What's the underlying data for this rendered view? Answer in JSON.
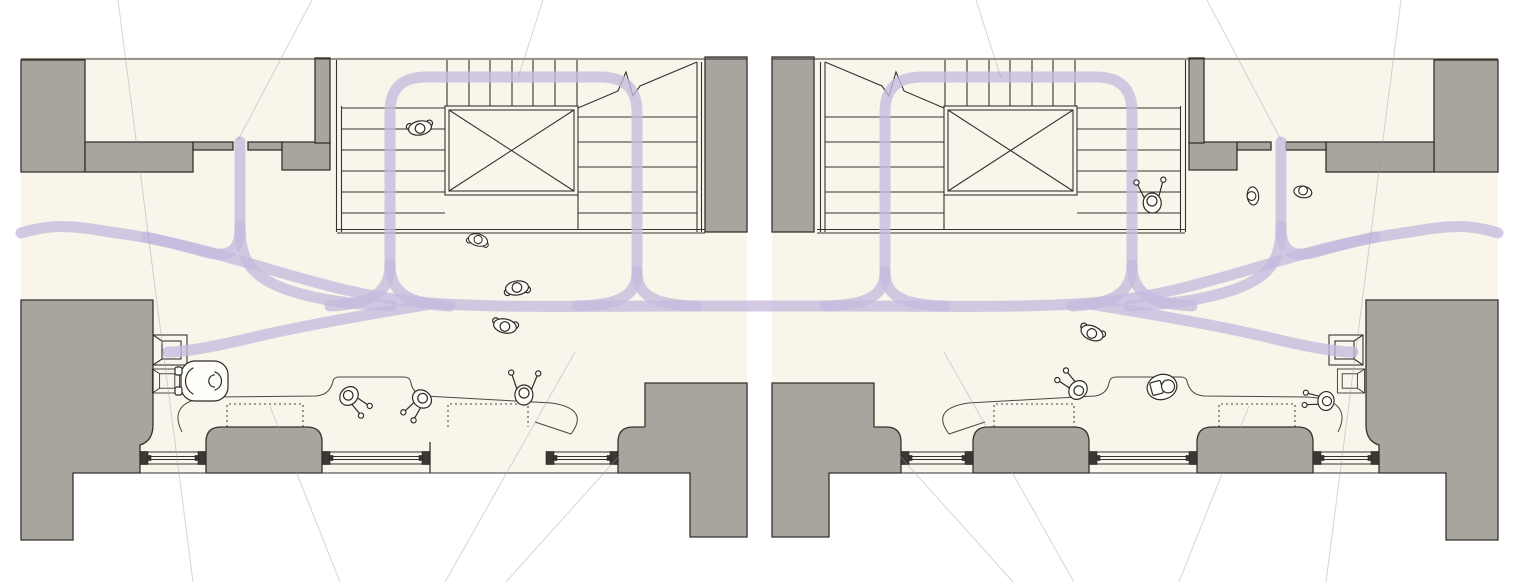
{
  "title": "Architectural floor plan diagram — two mirrored lobby variants with circulation flow lines, stair cores, window benches and occupant figures",
  "colors": {
    "paper": "#faf5eb",
    "exterior": "#ffffff",
    "wall_fill": "#a8a49e",
    "line_ink": "#35332f",
    "circulation_purple": "#c7bade",
    "leader_gray": "#9d98b0",
    "figure_fill": "#fffdf7"
  },
  "panels": [
    {
      "id": "left-plan",
      "label": "left plan variant"
    },
    {
      "id": "right-plan",
      "label": "right plan variant"
    }
  ],
  "circulation": {
    "stroke_width": 11,
    "opacity": 0.78,
    "paths": [
      "M390,265 L390,112 Q390,77 426,77 L600,77 Q637,77 637,112 L637,272",
      "M390,265 C390,295 368,304 330,306",
      "M390,265 C390,295 412,304 450,306",
      "M637,272 C637,298 615,305 577,306",
      "M637,272 C637,298 659,305 697,306",
      "M21,233 C50,224 70,225 110,232 C230,247 320,296 430,303 C500,308 560,306 700,306 L820,306 C960,306 1020,308 1090,303 C1200,296 1290,247 1410,232 C1450,225 1470,224 1498,233",
      "M240,142 L240,228 C240,252 228,258 205,252 C188,247 168,242 146,237",
      "M240,226 C240,262 252,276 285,289 C320,301 352,304 392,306",
      "M432,304 C345,318 282,330 242,340 C207,348 182,352 168,352",
      "M1132,265 L1132,112 Q1132,77 1096,77 L922,77 Q885,77 885,112 L885,272",
      "M1132,265 C1132,295 1154,304 1192,306",
      "M1132,265 C1132,295 1110,304 1072,306",
      "M885,272 C885,298 907,305 945,306",
      "M885,272 C885,298 863,305 825,306",
      "M1281,142 L1281,228 C1281,252 1293,258 1316,252 C1333,247 1353,242 1375,237",
      "M1281,226 C1281,262 1269,276 1236,289 C1201,301 1169,304 1129,306",
      "M1089,304 C1176,318 1239,330 1279,340 C1314,348 1339,352 1353,352"
    ]
  },
  "benches": [
    {
      "x": 227,
      "y": 404,
      "w": 76,
      "h": 23
    },
    {
      "x": 448,
      "y": 404,
      "w": 80,
      "h": 23
    },
    {
      "x": 994,
      "y": 404,
      "w": 80,
      "h": 23
    },
    {
      "x": 1219,
      "y": 404,
      "w": 76,
      "h": 23
    }
  ],
  "figures": [
    {
      "type": "person-walk",
      "layer": "people",
      "x": 420,
      "y": 128,
      "rot": 170,
      "scale": 1
    },
    {
      "type": "person-walk",
      "layer": "people",
      "x": 478,
      "y": 240,
      "rot": 15,
      "scale": 0.85
    },
    {
      "type": "person-walk",
      "layer": "people",
      "x": 517,
      "y": 288,
      "rot": -8,
      "scale": 1
    },
    {
      "type": "person-walk",
      "layer": "people",
      "x": 505,
      "y": 326,
      "rot": 192,
      "scale": 1
    },
    {
      "type": "wheelchair-user",
      "layer": "people",
      "x": 208,
      "y": 381,
      "rot": 0,
      "scale": 1
    },
    {
      "type": "person-seated",
      "layer": "people",
      "x": 349,
      "y": 396,
      "rot": -48,
      "scale": 1
    },
    {
      "type": "person-seated",
      "layer": "people",
      "x": 422,
      "y": 399,
      "rot": 38,
      "scale": 1
    },
    {
      "type": "person-armsup",
      "layer": "people",
      "x": 524,
      "y": 393,
      "rot": 2,
      "scale": 1
    },
    {
      "type": "person-armsup",
      "layer": "people",
      "x": 1152,
      "y": 201,
      "rot": -6,
      "scale": 1
    },
    {
      "type": "person-head",
      "layer": "people",
      "x": 1252,
      "y": 196,
      "rot": -95,
      "scale": 0.95
    },
    {
      "type": "person-head",
      "layer": "people",
      "x": 1303,
      "y": 191,
      "rot": 10,
      "scale": 0.95
    },
    {
      "type": "person-walk",
      "layer": "people",
      "x": 1092,
      "y": 333,
      "rot": 203,
      "scale": 1
    },
    {
      "type": "person-seated",
      "layer": "people",
      "x": 1078,
      "y": 390,
      "rot": 132,
      "scale": 1
    },
    {
      "type": "person-book",
      "layer": "people",
      "x": 1162,
      "y": 387,
      "rot": -15,
      "scale": 1
    },
    {
      "type": "person-seated",
      "layer": "people",
      "x": 1326,
      "y": 401,
      "rot": 96,
      "scale": 0.95
    },
    {
      "type": "stool",
      "layer": "furniture",
      "x": 170,
      "y": 350,
      "rot": 0,
      "scale": 1
    },
    {
      "type": "stool",
      "layer": "furniture",
      "x": 166,
      "y": 381,
      "rot": 0,
      "scale": 0.8
    },
    {
      "type": "stool",
      "layer": "furniture",
      "x": 1346,
      "y": 350,
      "rot": 180,
      "scale": 1
    },
    {
      "type": "stool",
      "layer": "furniture",
      "x": 1351,
      "y": 381,
      "rot": 180,
      "scale": 0.8
    }
  ],
  "leaders": [
    {
      "x1": 118,
      "y1": 0,
      "x2": 193,
      "y2": 582
    },
    {
      "x1": 312,
      "y1": 0,
      "x2": 238,
      "y2": 140
    },
    {
      "x1": 543,
      "y1": 0,
      "x2": 518,
      "y2": 78
    },
    {
      "x1": 270,
      "y1": 406,
      "x2": 340,
      "y2": 582
    },
    {
      "x1": 575,
      "y1": 352,
      "x2": 445,
      "y2": 582
    },
    {
      "x1": 683,
      "y1": 385,
      "x2": 506,
      "y2": 582
    },
    {
      "x1": 1401,
      "y1": 0,
      "x2": 1326,
      "y2": 582
    },
    {
      "x1": 1207,
      "y1": 0,
      "x2": 1281,
      "y2": 140
    },
    {
      "x1": 976,
      "y1": 0,
      "x2": 1001,
      "y2": 78
    },
    {
      "x1": 1249,
      "y1": 406,
      "x2": 1179,
      "y2": 582
    },
    {
      "x1": 944,
      "y1": 352,
      "x2": 1074,
      "y2": 582
    },
    {
      "x1": 836,
      "y1": 385,
      "x2": 1013,
      "y2": 582
    }
  ]
}
